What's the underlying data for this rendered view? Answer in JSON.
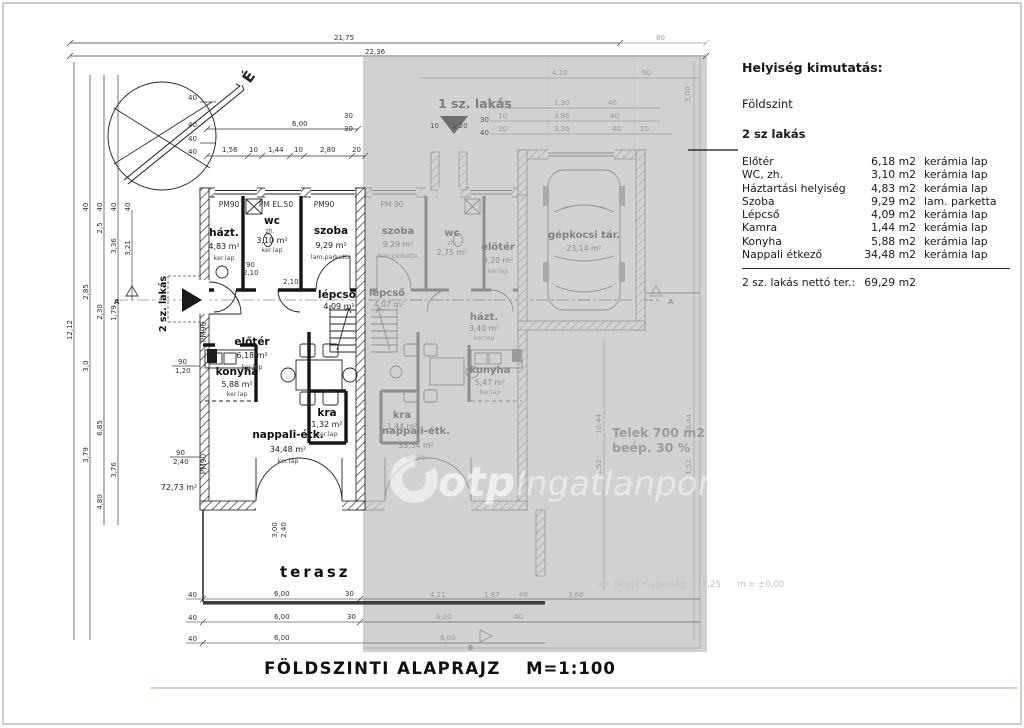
{
  "drawing": {
    "title": "FÖLDSZINTI ALAPRAJZ",
    "scale": "M=1:100"
  },
  "schedule": {
    "title": "Helyiség kimutatás:",
    "floor": "Földszint",
    "unit": "2 sz lakás",
    "rows": [
      {
        "name": "Előtér",
        "area": "6,18 m2",
        "finish": "kerámia lap"
      },
      {
        "name": "WC, zh.",
        "area": "3,10 m2",
        "finish": "kerámia lap"
      },
      {
        "name": "Háztartási helyiség",
        "area": "4,83 m2",
        "finish": "kerámia lap"
      },
      {
        "name": "Szoba",
        "area": "9,29 m2",
        "finish": "lam. parketta"
      },
      {
        "name": "Lépcső",
        "area": "4,09 m2",
        "finish": "kerámia lap"
      },
      {
        "name": "Kamra",
        "area": "1,44 m2",
        "finish": "kerámia lap"
      },
      {
        "name": "Konyha",
        "area": "5,88 m2",
        "finish": "kerámia lap"
      },
      {
        "name": "Nappali étkező",
        "area": "34,48 m2",
        "finish": "kerámia lap"
      }
    ],
    "total_label": "2 sz. lakás nettó ter.:",
    "total_value": "69,29 m2"
  },
  "units": {
    "unit1": "1 sz. lakás",
    "unit2": "2 sz. lakás"
  },
  "rooms": {
    "u2": {
      "hazt": {
        "name": "házt.",
        "area": "4,83 m²",
        "finish": "ker.lap"
      },
      "wc": {
        "name": "wc",
        "sub": "zh.",
        "area": "3,10 m²",
        "finish": "ker.lap"
      },
      "szoba": {
        "name": "szoba",
        "area": "9,29 m²",
        "finish": "lam.parketta"
      },
      "eloter": {
        "name": "előtér",
        "area": "6,18 m²",
        "finish": "ker.lap"
      },
      "lepcso": {
        "name": "lépcső",
        "area": "4,09 m²",
        "finish": "ker.lap"
      },
      "kra": {
        "name": "kra",
        "area": "1,32 m²",
        "finish": "ker.lap"
      },
      "konyha": {
        "name": "konyha",
        "area": "5,88 m²",
        "finish": "ker.lap"
      },
      "nappali": {
        "name": "nappali-étk.",
        "area": "34,48 m²",
        "finish": "ker.lap"
      },
      "terasz": {
        "name": "terasz"
      },
      "gross_area": "72,73 m²"
    },
    "u1": {
      "szoba": {
        "name": "szoba",
        "area": "9,29 m²",
        "finish": "lam.parketta"
      },
      "wc": {
        "name": "wc",
        "sub": "zh.",
        "area": "2,75 m²",
        "finish": "ker.lap"
      },
      "eloter": {
        "name": "előtér",
        "area": "9,20 m²",
        "finish": "ker.lap"
      },
      "garage": {
        "name": "gépkocsi tár.",
        "area": "23,14 m²"
      },
      "lepcso": {
        "name": "lépcső",
        "area": "4,07 m²",
        "finish": "ker.lap"
      },
      "kra": {
        "name": "kra",
        "area": "1,44 m²",
        "finish": "ker.lap"
      },
      "hazt": {
        "name": "házt.",
        "area": "3,40 m²",
        "finish": "ker.lap"
      },
      "konyha": {
        "name": "konyha",
        "area": "5,47 m²",
        "finish": "ker.lap"
      },
      "nappali": {
        "name": "nappali-étk.",
        "area": "33,34 m²",
        "finish": "ker.lap"
      }
    }
  },
  "windows": {
    "pm90": "PM90",
    "pmel": "PM EL.50",
    "pm90s": "PM 90"
  },
  "site": {
    "line1": "Telek 700 m2",
    "line2": "beép. 30 %"
  },
  "levels": {
    "text": "ált. terepi magasság: 117,25",
    "datum": "m = ±0,00"
  },
  "watermark": {
    "brand": "otp",
    "suffix": "Ingatlanpont"
  },
  "compass": {
    "north": "É"
  },
  "markers": {
    "a": "A",
    "b": "B"
  },
  "dims": {
    "top1": "21,75",
    "top2": "22,36",
    "top80": "80",
    "w600": "6,00",
    "w156": "1,56",
    "w10": "10",
    "w144": "1,44",
    "w280": "2,80",
    "w20": "20",
    "w30": "30",
    "w40": "40",
    "h1212": "12,12",
    "h25": "2,5",
    "h336": "3,36",
    "h321": "3,21",
    "h285": "2,85",
    "h230": "2,30",
    "h179": "1,79",
    "h30": "3,0",
    "h685": "6,85",
    "h379": "3,79",
    "h376": "3,76",
    "h480": "4,80",
    "d90": "90",
    "d210": "2,10",
    "d120": "1,20",
    "d240": "2,40",
    "d300": "3,00",
    "g411": "4,11",
    "g187": "1,87",
    "g366": "3,66",
    "g410": "4,10",
    "g130": "1,30",
    "g386": "3,86",
    "g336": "3,36",
    "g500": "5,00",
    "g1044": "10,44",
    "g152": "1,52"
  }
}
